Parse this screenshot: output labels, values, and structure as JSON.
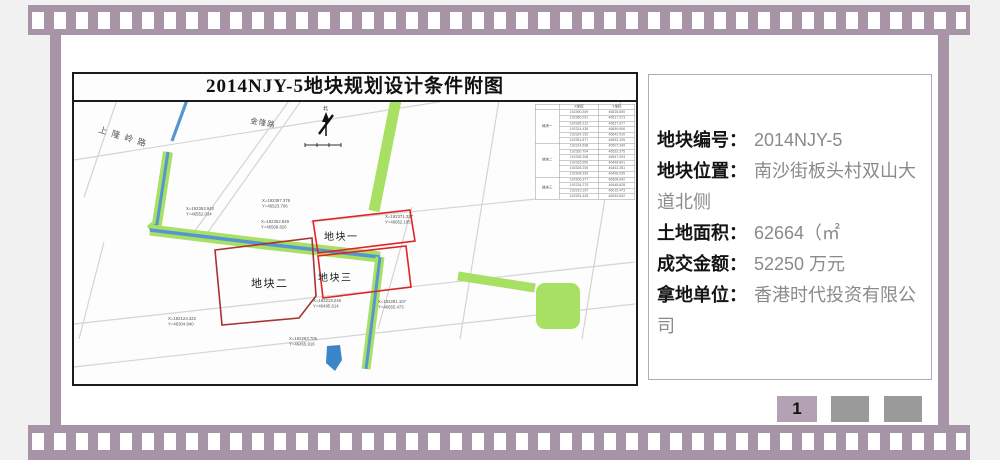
{
  "film": {
    "color": "#a794a7"
  },
  "map_doc": {
    "title": "2014NJY-5地块规划设计条件附图",
    "north_label": "北",
    "roads": {
      "shanglongling": "上隆岭路",
      "jinlong": "金隆路"
    },
    "parcels": [
      {
        "label": "地块一"
      },
      {
        "label": "地块二"
      },
      {
        "label": "地块三"
      }
    ],
    "coord_table": {
      "col_headers": [
        "X坐标",
        "Y坐标"
      ],
      "groups": [
        {
          "name": "地块一",
          "rows": [
            [
              "192390.309",
              "46528.690"
            ],
            [
              "192350.021",
              "46517.373"
            ],
            [
              "192335.212",
              "46527.677"
            ],
            [
              "192314.438",
              "46659.506"
            ],
            [
              "192324.192",
              "46642.410"
            ],
            [
              "192351.877",
              "46652.195"
            ]
          ]
        },
        {
          "name": "地块二",
          "rows": [
            [
              "192314.538",
              "46507.349"
            ],
            [
              "192330.704",
              "46532.375"
            ],
            [
              "192336.308",
              "46547.993"
            ],
            [
              "192315.950",
              "46448.841"
            ],
            [
              "192325.205",
              "46462.281"
            ],
            [
              "192308.333",
              "46498.935"
            ]
          ]
        },
        {
          "name": "地块三",
          "rows": [
            [
              "192306.377",
              "46508.642"
            ],
            [
              "192234.270",
              "46448.628"
            ],
            [
              "192210.197",
              "46015.473"
            ],
            [
              "192291.425",
              "46033.842"
            ]
          ]
        }
      ]
    },
    "annotations": [
      {
        "x": "X=192363.940",
        "y": "Y=46552.034"
      },
      {
        "x": "X=192397.378",
        "y": "Y=46523.706"
      },
      {
        "x": "X=192352.849",
        "y": "Y=46508.826"
      },
      {
        "x": "X=192371.327",
        "y": "Y=46652.195"
      },
      {
        "x": "X=192281.107",
        "y": "Y=46655.473"
      },
      {
        "x": "X=192124.322",
        "y": "Y=46304.840"
      },
      {
        "x": "X=192293.706",
        "y": "Y=46455.916"
      },
      {
        "x": "X=192219.245",
        "y": "Y=46495.614"
      }
    ],
    "colors": {
      "street": "#d4d4d4",
      "green": "#a7e063",
      "water": "#5596d2",
      "pond": "#3c85c8",
      "parcel_red": "#e02424",
      "parcel_dark_red": "#a83232"
    }
  },
  "info_panel": {
    "fields": [
      {
        "label": "地块编号：",
        "value": "2014NJY-5"
      },
      {
        "label": "地块位置：",
        "value": "南沙街板头村双山大道北侧"
      },
      {
        "label": "土地面积：",
        "value": "62664（㎡"
      },
      {
        "label": "成交金额：",
        "value": "52250 万元"
      },
      {
        "label": "拿地单位：",
        "value": "香港时代投资有限公司"
      }
    ]
  },
  "pagination": {
    "current": "1"
  }
}
